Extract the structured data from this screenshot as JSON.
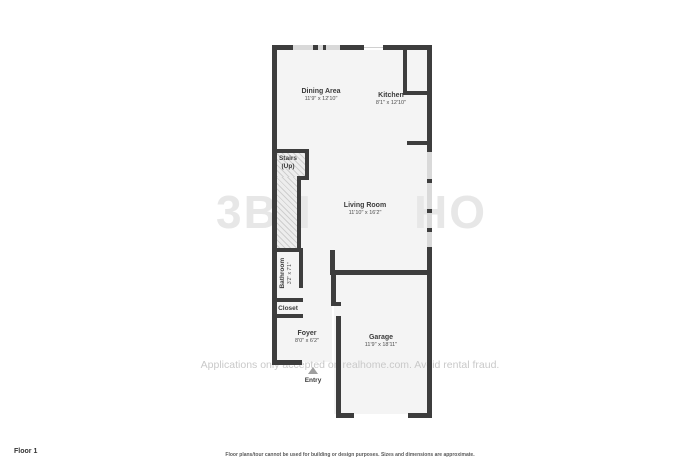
{
  "floor_label": "Floor 1",
  "disclaimer": "Floor plans/tour cannot be used for building or design purposes. Sizes and dimensions are approximate.",
  "fraud_watermark": "Applications only accepted on realhome.com. Avoid rental fraud.",
  "watermark_logo": {
    "left": "3B",
    "mid": "I",
    "right": "HO"
  },
  "entry": {
    "label": "Entry"
  },
  "rooms": [
    {
      "name": "Dining Area",
      "dims": "11'9\" x 12'10\""
    },
    {
      "name": "Kitchen",
      "dims": "8'1\" x 12'10\""
    },
    {
      "name": "Stairs",
      "name2": "(Up)"
    },
    {
      "name": "Living Room",
      "dims": "11'10\" x 16'2\""
    },
    {
      "name": "Bathroom",
      "dims": "3'2\" x 7'1\""
    },
    {
      "name": "Closet"
    },
    {
      "name": "Foyer",
      "dims": "8'0\" x 6'2\""
    },
    {
      "name": "Garage",
      "dims": "11'9\" x 18'11\""
    }
  ],
  "colors": {
    "wall": "#3d3d3d",
    "floor": "#f4f4f4",
    "window": "#d9d9d9",
    "stairs_hatch": "#cfcfcf",
    "fraud_watermark_text": "#c9c9c9",
    "logo_watermark": "#e7e7e7",
    "label_text": "#3b3b3b"
  }
}
